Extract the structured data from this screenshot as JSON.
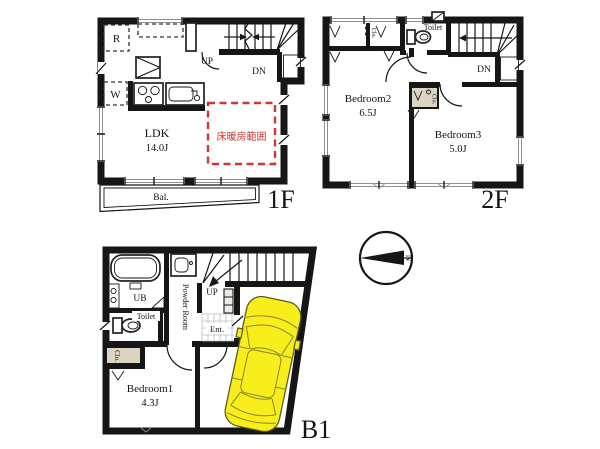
{
  "colors": {
    "wall": "#161616",
    "floor_heating_red": "#d23630",
    "car_yellow": "#f7ee1b",
    "closet_beige": "#dcd5c2"
  },
  "f1": {
    "floor_label": "1F",
    "ldk": "LDK",
    "ldk_size": "14.0J",
    "heating_note": "床暖房範囲",
    "balcony": "Bal.",
    "up": "UP",
    "dn": "DN",
    "fridge": "R",
    "washer": "W"
  },
  "f2": {
    "floor_label": "2F",
    "bedroom2": "Bedroom2",
    "bedroom2_size": "6.5J",
    "bedroom3": "Bedroom3",
    "bedroom3_size": "5.0J",
    "toilet": "Toilet",
    "closet_top": "Clo.",
    "closet_mid": "Clo.",
    "dn": "DN"
  },
  "b1": {
    "floor_label": "B1",
    "bedroom1": "Bedroom1",
    "bedroom1_size": "4.3J",
    "ub": "UB",
    "powder_room": "Powder Room",
    "toilet": "Toilet",
    "closet": "Clo.",
    "entrance": "Ent.",
    "up": "UP"
  },
  "compass": {
    "north": "N"
  }
}
